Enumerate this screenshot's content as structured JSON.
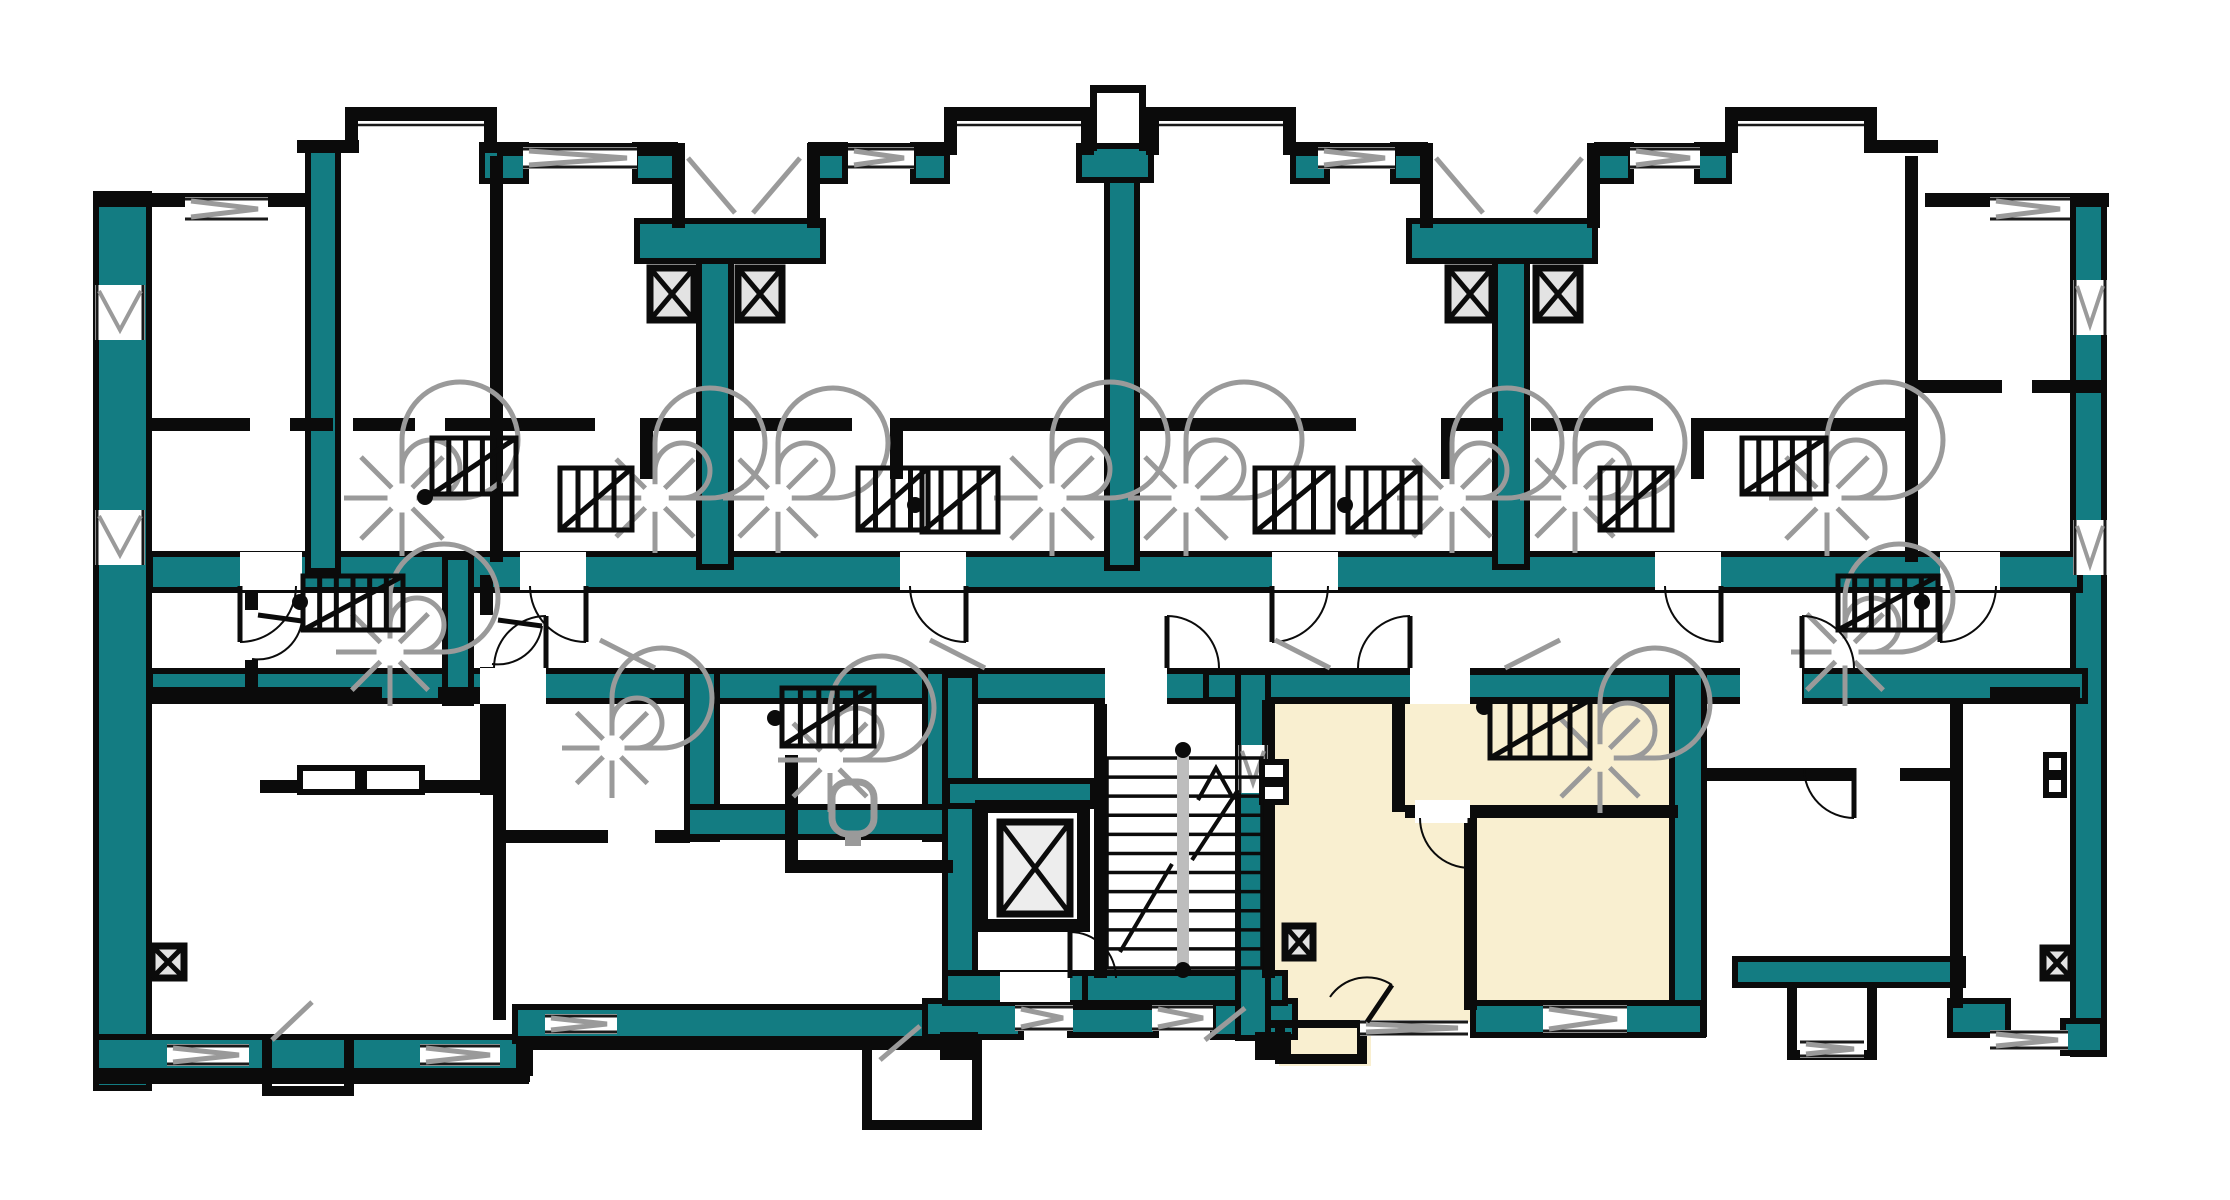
{
  "meta": {
    "type": "architectural-floor-plan",
    "description_names": [
      "building-floor-plan",
      "highlighted-apartment",
      "elevator-shaft",
      "main-staircase",
      "spiral-staircase",
      "ventilation-shaft",
      "toilet-fixture",
      "door-swing",
      "window-opening"
    ],
    "visible_text": []
  },
  "palette": {
    "background": "#ffffff",
    "wall_teal": "#137c82",
    "wall_black": "#0b0b0b",
    "stair_gray": "#9a9a9a",
    "rail_gray": "#bdbdbd",
    "vent_fill": "#e3e3e3",
    "elevator_fill": "#ededed",
    "highlight_cream": "#f9efd0",
    "window_line": "#1a1a1a"
  },
  "floorplan": {
    "cream_fills": [
      [
        1252,
        690,
        436,
        332
      ],
      [
        1279,
        1020,
        92,
        46
      ]
    ],
    "teal_rects": [
      [
        101,
        199,
        43,
        884
      ],
      [
        2078,
        204,
        21,
        845
      ],
      [
        155,
        559,
        1920,
        26
      ],
      [
        155,
        676,
        1925,
        20
      ],
      [
        313,
        154,
        20,
        412
      ],
      [
        704,
        262,
        22,
        300
      ],
      [
        1112,
        177,
        20,
        386
      ],
      [
        1500,
        262,
        22,
        300
      ],
      [
        1084,
        151,
        62,
        24
      ],
      [
        642,
        226,
        176,
        30
      ],
      [
        1414,
        226,
        176,
        30
      ],
      [
        487,
        150,
        34,
        26
      ],
      [
        640,
        150,
        30,
        26
      ],
      [
        816,
        150,
        24,
        26
      ],
      [
        918,
        150,
        24,
        26
      ],
      [
        1298,
        150,
        24,
        26
      ],
      [
        1398,
        150,
        22,
        26
      ],
      [
        1602,
        150,
        24,
        26
      ],
      [
        1702,
        150,
        22,
        26
      ],
      [
        101,
        1042,
        424,
        26
      ],
      [
        520,
        1012,
        440,
        24
      ],
      [
        930,
        1006,
        86,
        26
      ],
      [
        1075,
        1012,
        76,
        18
      ],
      [
        1218,
        1006,
        72,
        26
      ],
      [
        692,
        676,
        20,
        158
      ],
      [
        930,
        676,
        20,
        158
      ],
      [
        692,
        812,
        258,
        20
      ],
      [
        950,
        680,
        20,
        300
      ],
      [
        952,
        786,
        136,
        15
      ],
      [
        950,
        978,
        138,
        20
      ],
      [
        1090,
        978,
        190,
        20
      ],
      [
        450,
        562,
        16,
        136
      ],
      [
        1211,
        677,
        585,
        18
      ],
      [
        1243,
        677,
        20,
        356
      ],
      [
        1677,
        677,
        22,
        352
      ],
      [
        1478,
        1008,
        220,
        22
      ],
      [
        1740,
        964,
        218,
        16
      ],
      [
        1955,
        1006,
        48,
        24
      ],
      [
        2068,
        1026,
        30,
        22
      ]
    ],
    "black_rects": [
      [
        95,
        193,
        215,
        14
      ],
      [
        297,
        140,
        62,
        13
      ],
      [
        345,
        107,
        152,
        14
      ],
      [
        345,
        107,
        13,
        46
      ],
      [
        484,
        107,
        13,
        46
      ],
      [
        497,
        143,
        178,
        13
      ],
      [
        672,
        143,
        13,
        85
      ],
      [
        807,
        143,
        13,
        85
      ],
      [
        820,
        143,
        126,
        13
      ],
      [
        944,
        107,
        150,
        14
      ],
      [
        944,
        107,
        13,
        48
      ],
      [
        1081,
        107,
        13,
        48
      ],
      [
        1090,
        85,
        56,
        8
      ],
      [
        1090,
        85,
        7,
        66
      ],
      [
        1139,
        85,
        7,
        66
      ],
      [
        1146,
        107,
        150,
        14
      ],
      [
        1146,
        107,
        13,
        48
      ],
      [
        1283,
        107,
        13,
        48
      ],
      [
        1296,
        143,
        126,
        13
      ],
      [
        1420,
        143,
        13,
        85
      ],
      [
        1587,
        143,
        13,
        85
      ],
      [
        1600,
        143,
        127,
        13
      ],
      [
        1725,
        107,
        152,
        14
      ],
      [
        1725,
        107,
        13,
        46
      ],
      [
        1864,
        107,
        13,
        46
      ],
      [
        1877,
        140,
        61,
        13
      ],
      [
        1925,
        193,
        184,
        14
      ],
      [
        490,
        156,
        13,
        406
      ],
      [
        1905,
        156,
        13,
        406
      ],
      [
        150,
        418,
        100,
        13
      ],
      [
        290,
        418,
        43,
        13
      ],
      [
        353,
        418,
        62,
        13
      ],
      [
        445,
        418,
        47,
        13
      ],
      [
        503,
        418,
        92,
        13
      ],
      [
        640,
        418,
        62,
        13
      ],
      [
        730,
        418,
        122,
        13
      ],
      [
        890,
        418,
        219,
        13
      ],
      [
        1137,
        418,
        219,
        13
      ],
      [
        1441,
        418,
        62,
        13
      ],
      [
        1531,
        418,
        122,
        13
      ],
      [
        1691,
        418,
        216,
        13
      ],
      [
        1918,
        380,
        84,
        13
      ],
      [
        2032,
        380,
        75,
        13
      ],
      [
        640,
        431,
        13,
        48
      ],
      [
        890,
        431,
        13,
        48
      ],
      [
        1441,
        431,
        13,
        48
      ],
      [
        1691,
        431,
        13,
        48
      ],
      [
        245,
        575,
        13,
        118
      ],
      [
        150,
        687,
        232,
        13
      ],
      [
        438,
        687,
        42,
        13
      ],
      [
        480,
        575,
        13,
        220
      ],
      [
        260,
        780,
        224,
        13
      ],
      [
        493,
        700,
        13,
        320
      ],
      [
        506,
        830,
        102,
        13
      ],
      [
        655,
        830,
        35,
        13
      ],
      [
        785,
        755,
        13,
        112
      ],
      [
        785,
        860,
        168,
        13
      ],
      [
        1094,
        700,
        13,
        278
      ],
      [
        1262,
        700,
        13,
        278
      ],
      [
        1392,
        700,
        13,
        112
      ],
      [
        1405,
        805,
        273,
        13
      ],
      [
        1464,
        818,
        13,
        192
      ],
      [
        1268,
        1020,
        200,
        8
      ],
      [
        1950,
        700,
        13,
        308
      ],
      [
        1704,
        768,
        150,
        13
      ],
      [
        1900,
        768,
        52,
        13
      ],
      [
        1990,
        687,
        90,
        14
      ],
      [
        95,
        1068,
        434,
        16
      ],
      [
        516,
        1036,
        14,
        46
      ],
      [
        516,
        1036,
        444,
        14
      ],
      [
        940,
        1032,
        38,
        28
      ],
      [
        1255,
        1032,
        36,
        28
      ],
      [
        262,
        1040,
        10,
        56
      ],
      [
        344,
        1040,
        10,
        56
      ],
      [
        262,
        1086,
        92,
        10
      ],
      [
        862,
        1038,
        10,
        92
      ],
      [
        972,
        1038,
        10,
        92
      ],
      [
        862,
        1120,
        120,
        10
      ],
      [
        1275,
        1028,
        10,
        36
      ],
      [
        1357,
        1028,
        10,
        36
      ],
      [
        1275,
        1054,
        92,
        10
      ],
      [
        1787,
        985,
        10,
        75
      ],
      [
        1867,
        985,
        10,
        75
      ],
      [
        1787,
        1050,
        90,
        10
      ],
      [
        975,
        800,
        115,
        132
      ]
    ],
    "white_insets": [
      [
        988,
        813,
        89,
        106
      ]
    ],
    "outline_boxes": [
      [
        300,
        768,
        58,
        24
      ],
      [
        364,
        768,
        58,
        24
      ],
      [
        1262,
        762,
        24,
        18
      ],
      [
        1262,
        784,
        24,
        18
      ],
      [
        2046,
        755,
        18,
        18
      ],
      [
        2046,
        777,
        18,
        18
      ]
    ],
    "windows": [
      [
        185,
        197,
        83,
        24,
        1,
        0
      ],
      [
        523,
        147,
        114,
        22,
        1,
        0
      ],
      [
        848,
        147,
        66,
        22,
        1,
        0
      ],
      [
        1318,
        147,
        77,
        22,
        1,
        0
      ],
      [
        1630,
        147,
        70,
        22,
        1,
        0
      ],
      [
        1990,
        197,
        80,
        24,
        1,
        0
      ],
      [
        358,
        121,
        126,
        8,
        0,
        0
      ],
      [
        957,
        121,
        124,
        8,
        0,
        0
      ],
      [
        1159,
        121,
        124,
        8,
        0,
        0
      ],
      [
        1738,
        121,
        126,
        8,
        0,
        0
      ],
      [
        95,
        285,
        50,
        55,
        1,
        1
      ],
      [
        95,
        510,
        50,
        55,
        1,
        1
      ],
      [
        2073,
        280,
        34,
        55,
        1,
        1
      ],
      [
        2073,
        520,
        34,
        55,
        1,
        1
      ],
      [
        1238,
        745,
        30,
        48,
        1,
        1
      ],
      [
        167,
        1044,
        82,
        22,
        1,
        0
      ],
      [
        420,
        1044,
        80,
        22,
        1,
        0
      ],
      [
        545,
        1014,
        72,
        20,
        1,
        0
      ],
      [
        1015,
        1005,
        58,
        26,
        1,
        0
      ],
      [
        1152,
        1005,
        61,
        26,
        1,
        0
      ],
      [
        1360,
        1020,
        108,
        16,
        1,
        0
      ],
      [
        1543,
        1005,
        84,
        28,
        1,
        0
      ],
      [
        1800,
        1040,
        64,
        18,
        1,
        0
      ],
      [
        1990,
        1030,
        78,
        20,
        1,
        0
      ]
    ],
    "punches": [
      [
        240,
        552,
        62,
        38
      ],
      [
        520,
        552,
        66,
        38
      ],
      [
        900,
        552,
        66,
        38
      ],
      [
        1272,
        552,
        66,
        38
      ],
      [
        1655,
        552,
        66,
        38
      ],
      [
        1940,
        552,
        60,
        38
      ],
      [
        480,
        668,
        66,
        36
      ],
      [
        1105,
        668,
        62,
        36
      ],
      [
        1410,
        668,
        60,
        36
      ],
      [
        1740,
        668,
        62,
        36
      ],
      [
        1000,
        972,
        70,
        30
      ],
      [
        240,
        610,
        23,
        50
      ],
      [
        475,
        615,
        23,
        52
      ],
      [
        1854,
        763,
        46,
        23
      ],
      [
        1415,
        800,
        55,
        23
      ]
    ],
    "vent_boxes": [
      [
        650,
        268,
        44,
        52
      ],
      [
        738,
        268,
        44,
        52
      ],
      [
        1448,
        268,
        44,
        52
      ],
      [
        1536,
        268,
        44,
        52
      ],
      [
        152,
        946,
        32,
        32
      ],
      [
        1285,
        926,
        28,
        32
      ],
      [
        2043,
        948,
        28,
        30
      ]
    ],
    "elevator_box": [
      1000,
      822,
      70,
      92
    ],
    "spirals": [
      [
        402,
        498,
        58
      ],
      [
        655,
        498,
        55
      ],
      [
        778,
        498,
        55
      ],
      [
        1052,
        498,
        58
      ],
      [
        1186,
        498,
        58
      ],
      [
        1452,
        498,
        55
      ],
      [
        1575,
        498,
        55
      ],
      [
        1827,
        498,
        58
      ],
      [
        390,
        652,
        54
      ],
      [
        1845,
        652,
        54
      ],
      [
        612,
        748,
        50
      ],
      [
        830,
        760,
        52
      ],
      [
        1600,
        758,
        55
      ]
    ],
    "tread_grids": [
      [
        432,
        438,
        84,
        56,
        5
      ],
      [
        560,
        468,
        72,
        62,
        4
      ],
      [
        858,
        468,
        70,
        62,
        4
      ],
      [
        922,
        468,
        76,
        64,
        4
      ],
      [
        1255,
        468,
        78,
        64,
        4
      ],
      [
        1348,
        468,
        72,
        64,
        4
      ],
      [
        1600,
        468,
        72,
        62,
        4
      ],
      [
        1742,
        438,
        84,
        56,
        5
      ],
      [
        303,
        576,
        100,
        54,
        6
      ],
      [
        1838,
        576,
        100,
        54,
        6
      ],
      [
        782,
        688,
        92,
        58,
        5
      ],
      [
        1490,
        700,
        100,
        58,
        5
      ]
    ],
    "main_stair": {
      "x": 1107,
      "y": 758,
      "w": 155,
      "h": 210,
      "treads": 10,
      "rail": [
        1177,
        756,
        12,
        210
      ],
      "arrow_lines": [
        [
          1120,
          952,
          1172,
          864
        ],
        [
          1192,
          860,
          1238,
          790
        ]
      ],
      "arrow_head": [
        [
          1198,
          800
        ],
        [
          1216,
          768
        ],
        [
          1234,
          800
        ]
      ]
    },
    "door_arcs": [
      [
        240,
        586,
        0,
        56,
        0
      ],
      [
        586,
        586,
        0,
        56,
        1
      ],
      [
        966,
        586,
        0,
        56,
        1
      ],
      [
        1272,
        586,
        0,
        56,
        0
      ],
      [
        1721,
        586,
        0,
        56,
        1
      ],
      [
        1940,
        586,
        0,
        56,
        0
      ],
      [
        546,
        668,
        0,
        -52,
        0
      ],
      [
        1167,
        668,
        0,
        -52,
        1
      ],
      [
        1410,
        668,
        0,
        -52,
        0
      ],
      [
        1802,
        668,
        0,
        -52,
        1
      ],
      [
        1470,
        818,
        0,
        50,
        1
      ],
      [
        1367,
        1022,
        25,
        -37,
        0
      ],
      [
        1854,
        768,
        0,
        50,
        1
      ],
      [
        1070,
        978,
        0,
        -46,
        1
      ],
      [
        258,
        615,
        44,
        6,
        1
      ],
      [
        498,
        620,
        44,
        6,
        1
      ]
    ],
    "gray_lines": [
      [
        688,
        158,
        735,
        213
      ],
      [
        800,
        158,
        753,
        213
      ],
      [
        1436,
        158,
        1483,
        213
      ],
      [
        1582,
        158,
        1535,
        213
      ],
      [
        600,
        640,
        655,
        668
      ],
      [
        930,
        640,
        985,
        668
      ],
      [
        1275,
        640,
        1330,
        668
      ],
      [
        1560,
        640,
        1505,
        668
      ],
      [
        272,
        1040,
        312,
        1002
      ],
      [
        880,
        1060,
        920,
        1026
      ],
      [
        1205,
        1040,
        1245,
        1008
      ]
    ],
    "rail_dots": [
      [
        425,
        497
      ],
      [
        915,
        505
      ],
      [
        1345,
        505
      ],
      [
        300,
        602
      ],
      [
        1922,
        602
      ],
      [
        775,
        718
      ],
      [
        1484,
        707
      ],
      [
        1183,
        750
      ],
      [
        1183,
        970
      ]
    ],
    "toilet": [
      832,
      782,
      42,
      52
    ]
  },
  "highlight_unit": {
    "name": "selected-apartment",
    "bounds": [
      1238,
      672,
      466,
      396
    ],
    "fill": "#f9efd0"
  }
}
